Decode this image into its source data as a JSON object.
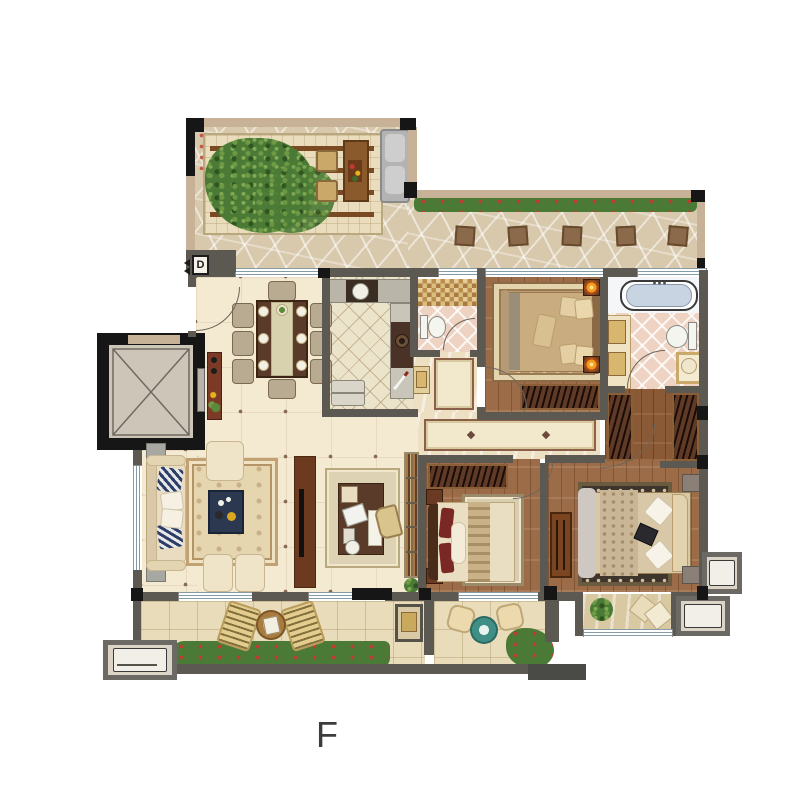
{
  "labels": {
    "unit_label": "F",
    "door_marker": "D"
  },
  "palette": {
    "wall": "#5c5952",
    "column": "#161616",
    "exterior_wall": "#c7b197",
    "cream": "#f4ead2",
    "wood": "#9c6c48",
    "wood_dark": "#8a5936",
    "terrace": "#d8c9ac",
    "balcony": "#e9dcba",
    "kitchen_tile": "#ece3cb",
    "bath_tile": "#eed3c2",
    "water": "#c9d4e2",
    "hedge": "#4a7a35",
    "accent_red": "#c23b2e",
    "navy": "#2c3850",
    "lamp": "#f59a1a"
  }
}
